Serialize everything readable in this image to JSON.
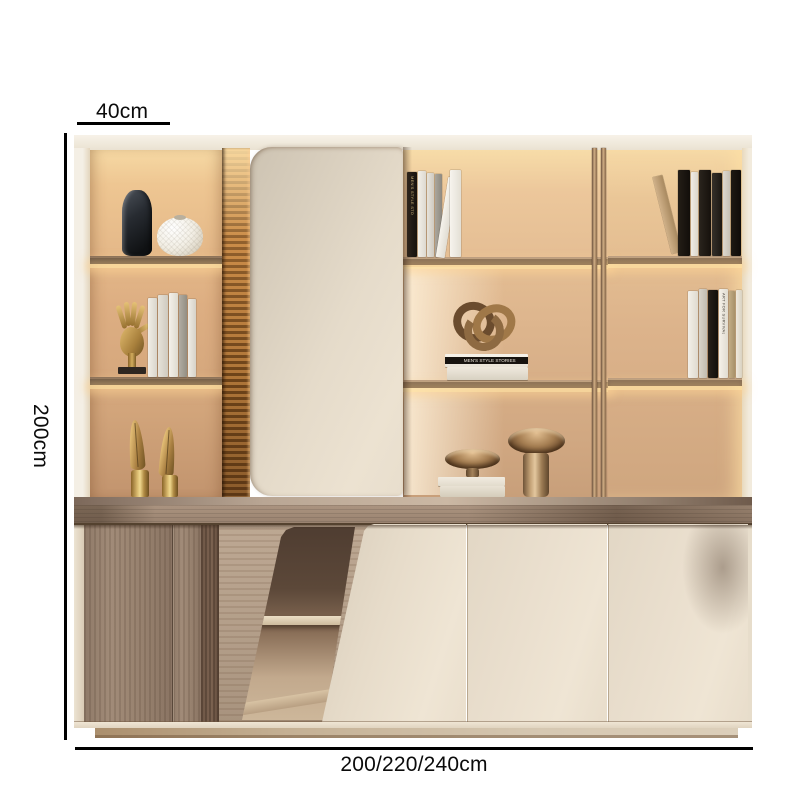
{
  "annotations": {
    "width_top_label": "40cm",
    "height_left_label": "200cm",
    "width_bottom_label": "200/220/240cm"
  },
  "decor_text": {
    "book_stack_band": "MEN'S STYLE STORIES",
    "spine_middle_top": "MEN'S STYLE STORIES",
    "spine_right_mid": "ART FOR SURVIVAL"
  },
  "palette": {
    "background": "#ffffff",
    "dimension_line": "#000000",
    "backlight_glow": "#f6d9a4",
    "back_panel": "#d7ad82",
    "shelf_dark": "#4f3e33",
    "shelf_bronze": "#6e5847",
    "bronze_rail": "#cdab82",
    "cream_door": "#e7dccb",
    "fluted_wood": "#bd823f",
    "base_wood": "#97816e",
    "counter": "#9a8370",
    "plinth": "#c4b094",
    "gold_decor": "#c9a45f"
  }
}
